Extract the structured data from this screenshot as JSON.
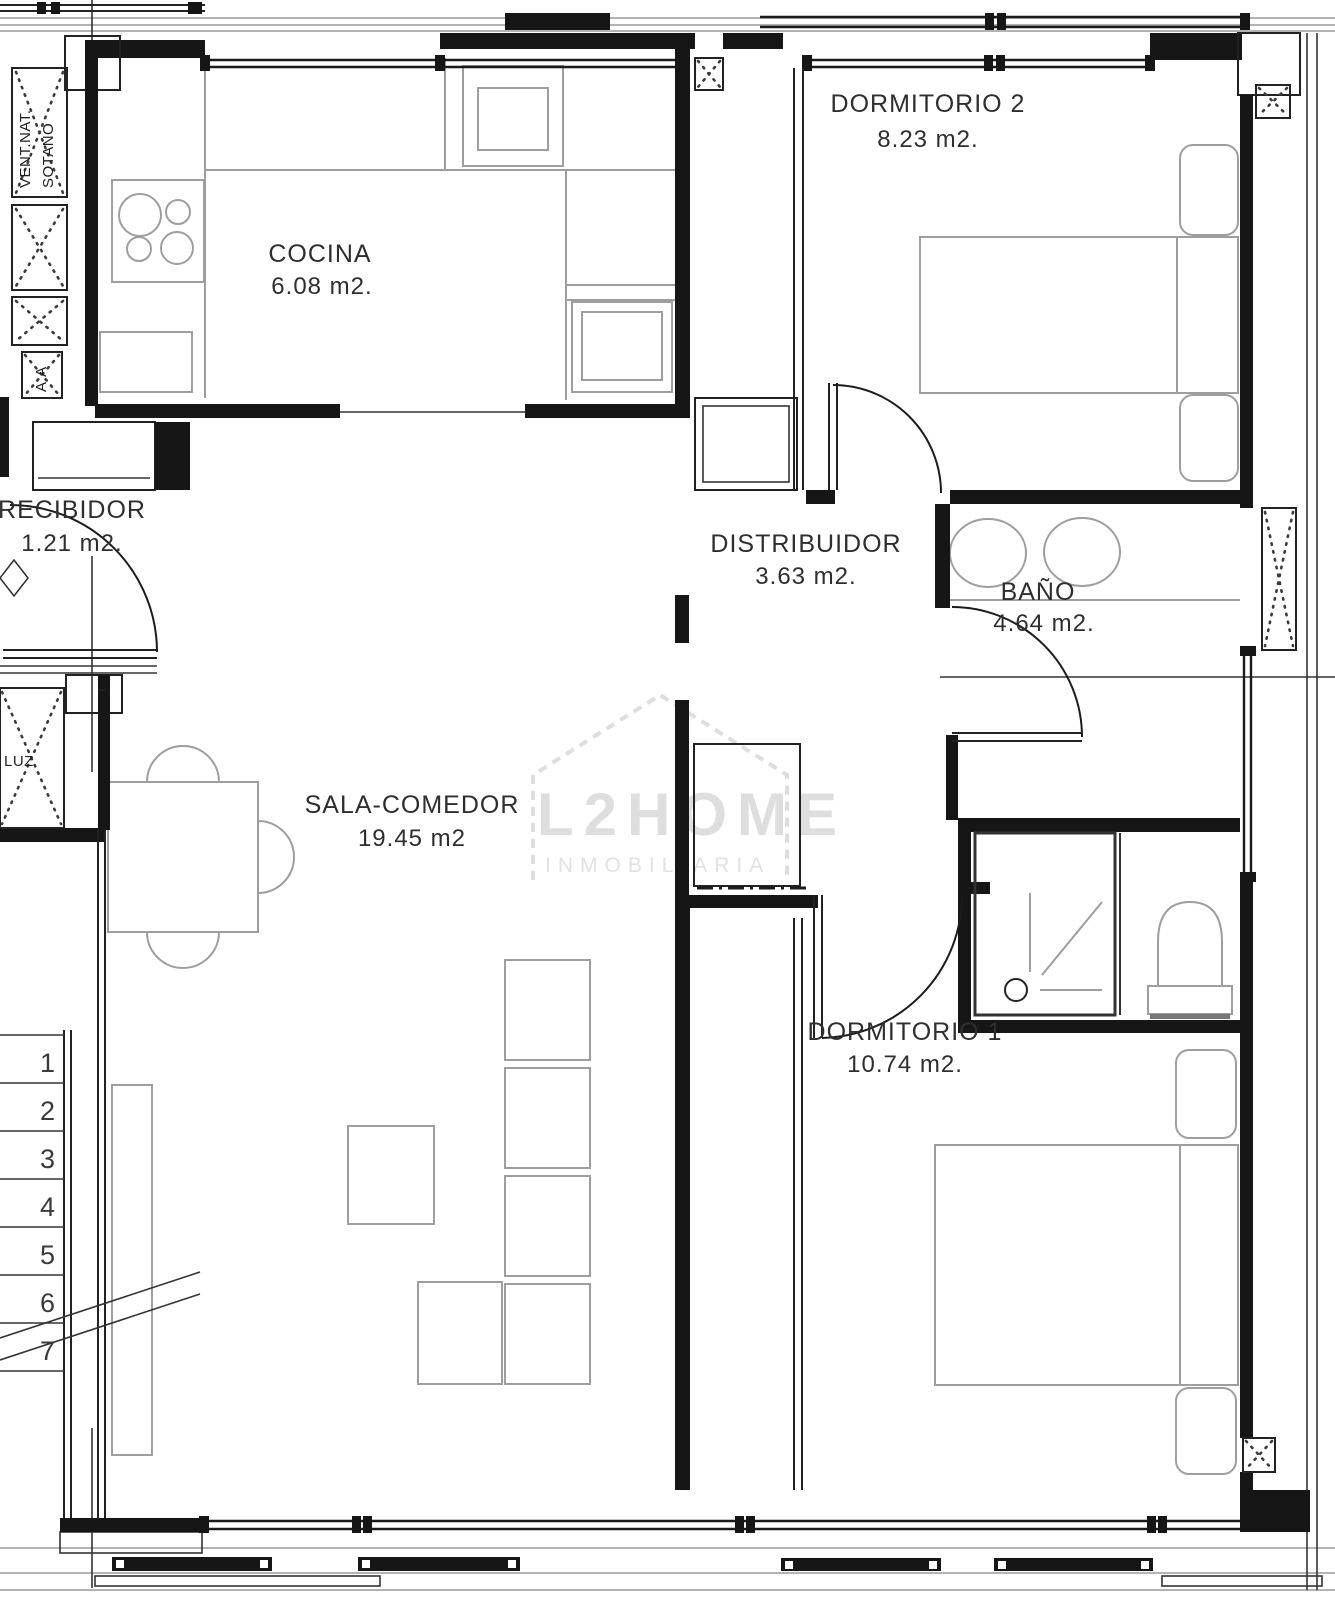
{
  "title": "Apartment floor plan",
  "colors": {
    "wall": "#161616",
    "furniture": "#9e9e9e",
    "text": "#2e2e2e",
    "watermark": "#dedede",
    "background": "#ffffff"
  },
  "rooms": {
    "cocina": {
      "name": "COCINA",
      "area": "6.08 m2."
    },
    "dormitorio2": {
      "name": "DORMITORIO 2",
      "area": "8.23 m2."
    },
    "recibidor": {
      "name": "RECIBIDOR",
      "area": "1.21 m2."
    },
    "distribuidor": {
      "name": "DISTRIBUIDOR",
      "area": "3.63 m2."
    },
    "bano": {
      "name": "BAÑO",
      "area": "4.64 m2."
    },
    "sala": {
      "name": "SALA-COMEDOR",
      "area": "19.45 m2"
    },
    "dormitorio1": {
      "name": "DORMITORIO 1",
      "area": "10.74 m2."
    }
  },
  "shafts": {
    "vent_line1": "VENT.NAT.",
    "vent_line2": "SOTANO",
    "aa": "A.A",
    "luz": "LUZ"
  },
  "stairs": {
    "treads": [
      "1",
      "2",
      "3",
      "4",
      "5",
      "6",
      "7"
    ]
  },
  "watermark": {
    "brand": "L2HOME",
    "subtitle": "INMOBILIARIA"
  }
}
